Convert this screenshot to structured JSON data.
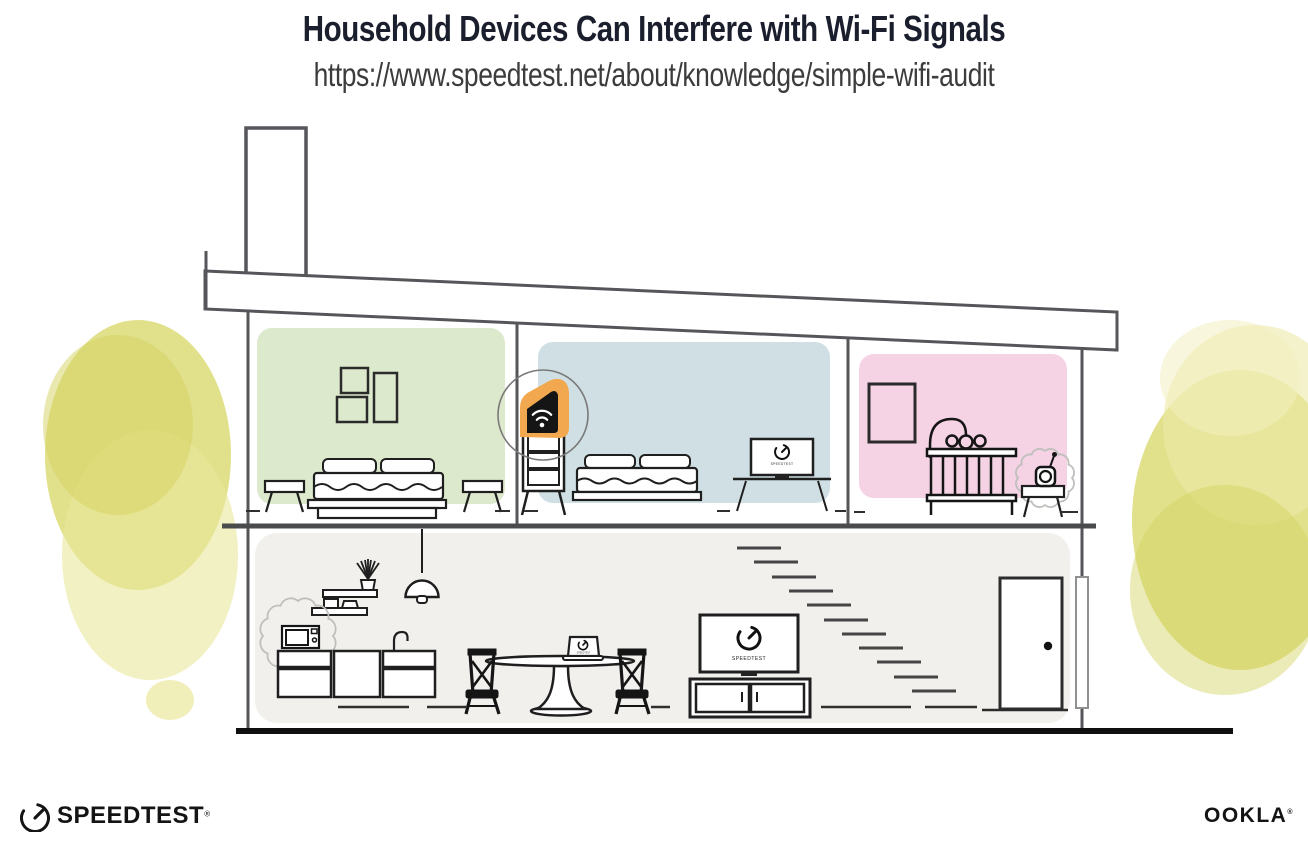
{
  "header": {
    "title": "Household Devices Can Interfere with Wi-Fi Signals",
    "url": "https://www.speedtest.net/about/knowledge/simple-wifi-audit"
  },
  "branding": {
    "speedtest_wordmark": "SPEEDTEST",
    "speedtest_reg": "®",
    "ookla_wordmark": "OOKLA",
    "ookla_reg": "®",
    "screen_brand": "SPEEDTEST"
  },
  "illustration": {
    "rooms": [
      {
        "name": "green-bedroom",
        "wall_color": "#dce9cc",
        "items": [
          "picture-frames",
          "bed",
          "nightstands"
        ]
      },
      {
        "name": "blue-bedroom",
        "wall_color": "#cfdfe3",
        "items": [
          "wifi-router-on-dresser",
          "bed",
          "tv-on-desk"
        ]
      },
      {
        "name": "pink-nursery",
        "wall_color": "#f5d3e5",
        "items": [
          "picture-frame",
          "crib-with-mobile",
          "baby-monitor-on-table"
        ]
      },
      {
        "name": "ground-floor",
        "wall_color": "#f1f0ed",
        "items": [
          "kitchen-shelves",
          "pendant-lamp",
          "microwave",
          "kitchen-cabinets",
          "dining-table-with-laptop",
          "chairs",
          "tv-on-console",
          "stairs",
          "front-door"
        ]
      }
    ],
    "interference_sources": [
      "microwave",
      "baby-monitor"
    ],
    "highlighted_device": "wifi-router"
  },
  "colors": {
    "title_text": "#1b1f2d",
    "url_text": "#3c3c3c",
    "room_green": "#dce9cc",
    "room_blue": "#cfdfe3",
    "room_pink": "#f5d3e5",
    "floor_gray": "#f1f0ed",
    "foliage_yellow": "#dcdc78",
    "router_orange": "#f1a84f",
    "structure_line": "#55565a",
    "ink": "#1f1f1f"
  }
}
